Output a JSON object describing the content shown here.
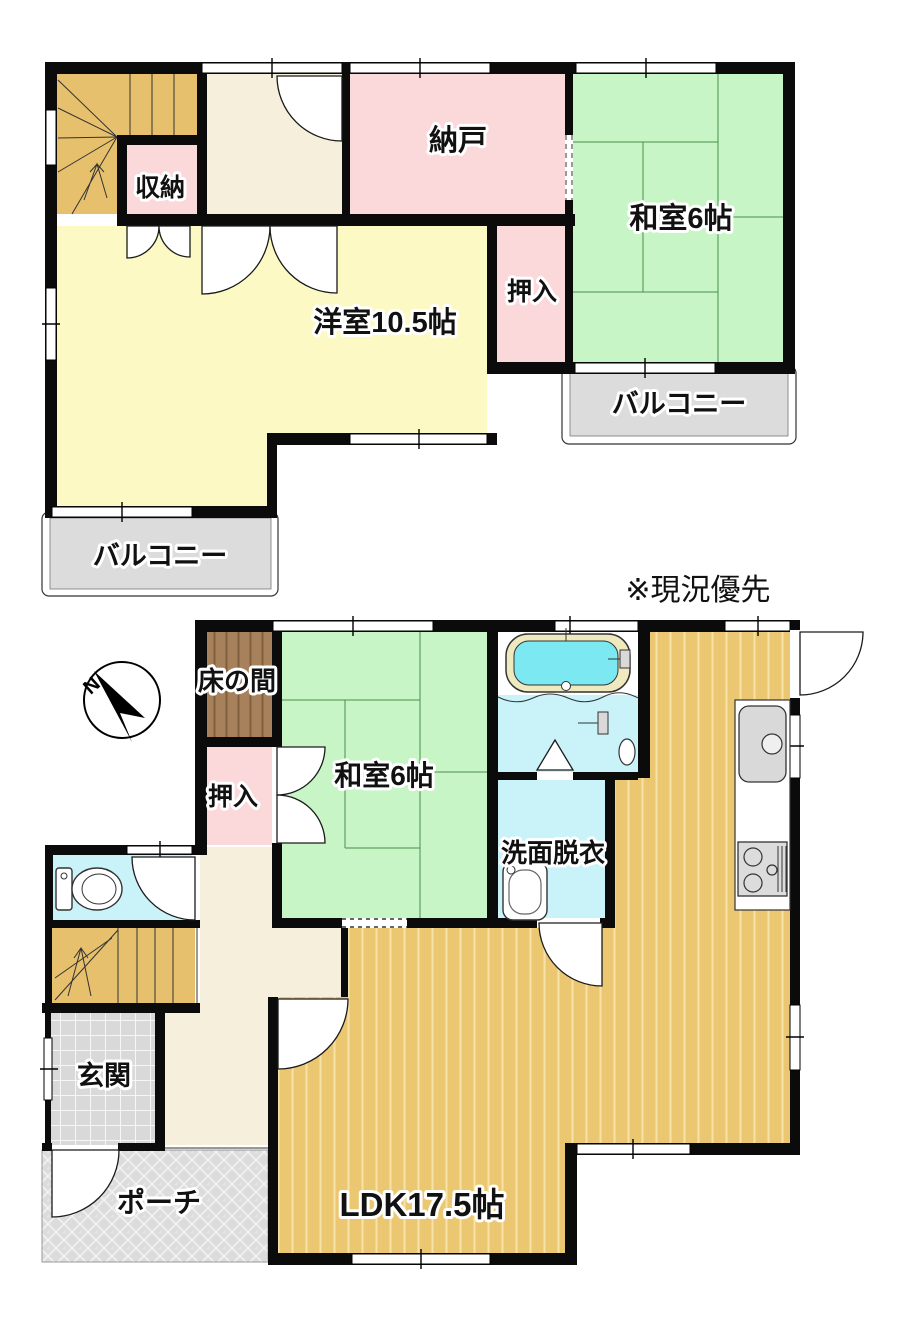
{
  "note_label": "※現況優先",
  "compass": {
    "north_label": "N"
  },
  "floor2": {
    "closet_label": "収納",
    "nando_label": "納戸",
    "washitsu_label": "和室6帖",
    "oshiire_label": "押入",
    "youshitsu_label": "洋室10.5帖",
    "balcony_east_label": "バルコニー",
    "balcony_west_label": "バルコニー"
  },
  "floor1": {
    "tokonoma_label": "床の間",
    "oshiire_label": "押入",
    "washitsu_label": "和室6帖",
    "senmen_label": "洗面脱衣",
    "genkan_label": "玄関",
    "porch_label": "ポーチ",
    "ldk_label": "LDK17.5帖"
  },
  "palette": {
    "wall": "#0b0b0b",
    "tatami_green": "#c8f5c5",
    "western_room_yellow": "#fcf9c4",
    "closet_pink": "#fbd9db",
    "hall_cream": "#f6efdb",
    "wood_floor_tan": "#ebc772",
    "stairs_tan": "#e6c06c",
    "balcony_gray": "#dcdcdc",
    "bath_cyan": "#c9f3f8",
    "tub_water": "#7ce9f2",
    "tokonoma_brown": "#a6815c"
  }
}
